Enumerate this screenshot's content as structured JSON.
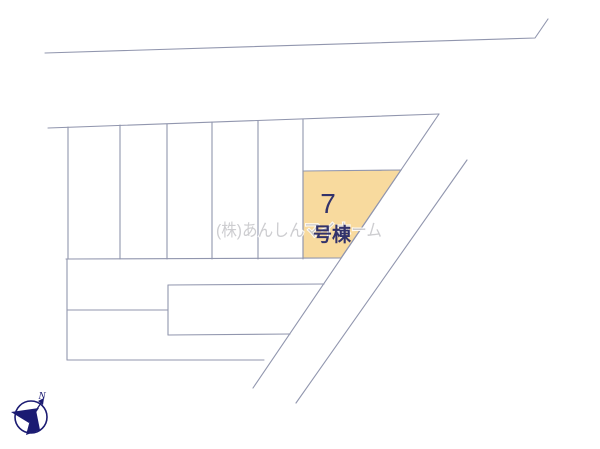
{
  "site_plan": {
    "title": "site-layout-plan",
    "highlighted_lot": {
      "number": "7",
      "label": "号棟"
    },
    "watermark": "(株)あんしんマイホーム",
    "compass": {
      "north_label": "N"
    },
    "colors": {
      "background": "#FFFFFF",
      "lot_fill": "#F8DA9E",
      "line": "#9196AE",
      "label": "#32326B",
      "watermark": "#C8C8CC",
      "compass": "#1B1B72"
    }
  }
}
